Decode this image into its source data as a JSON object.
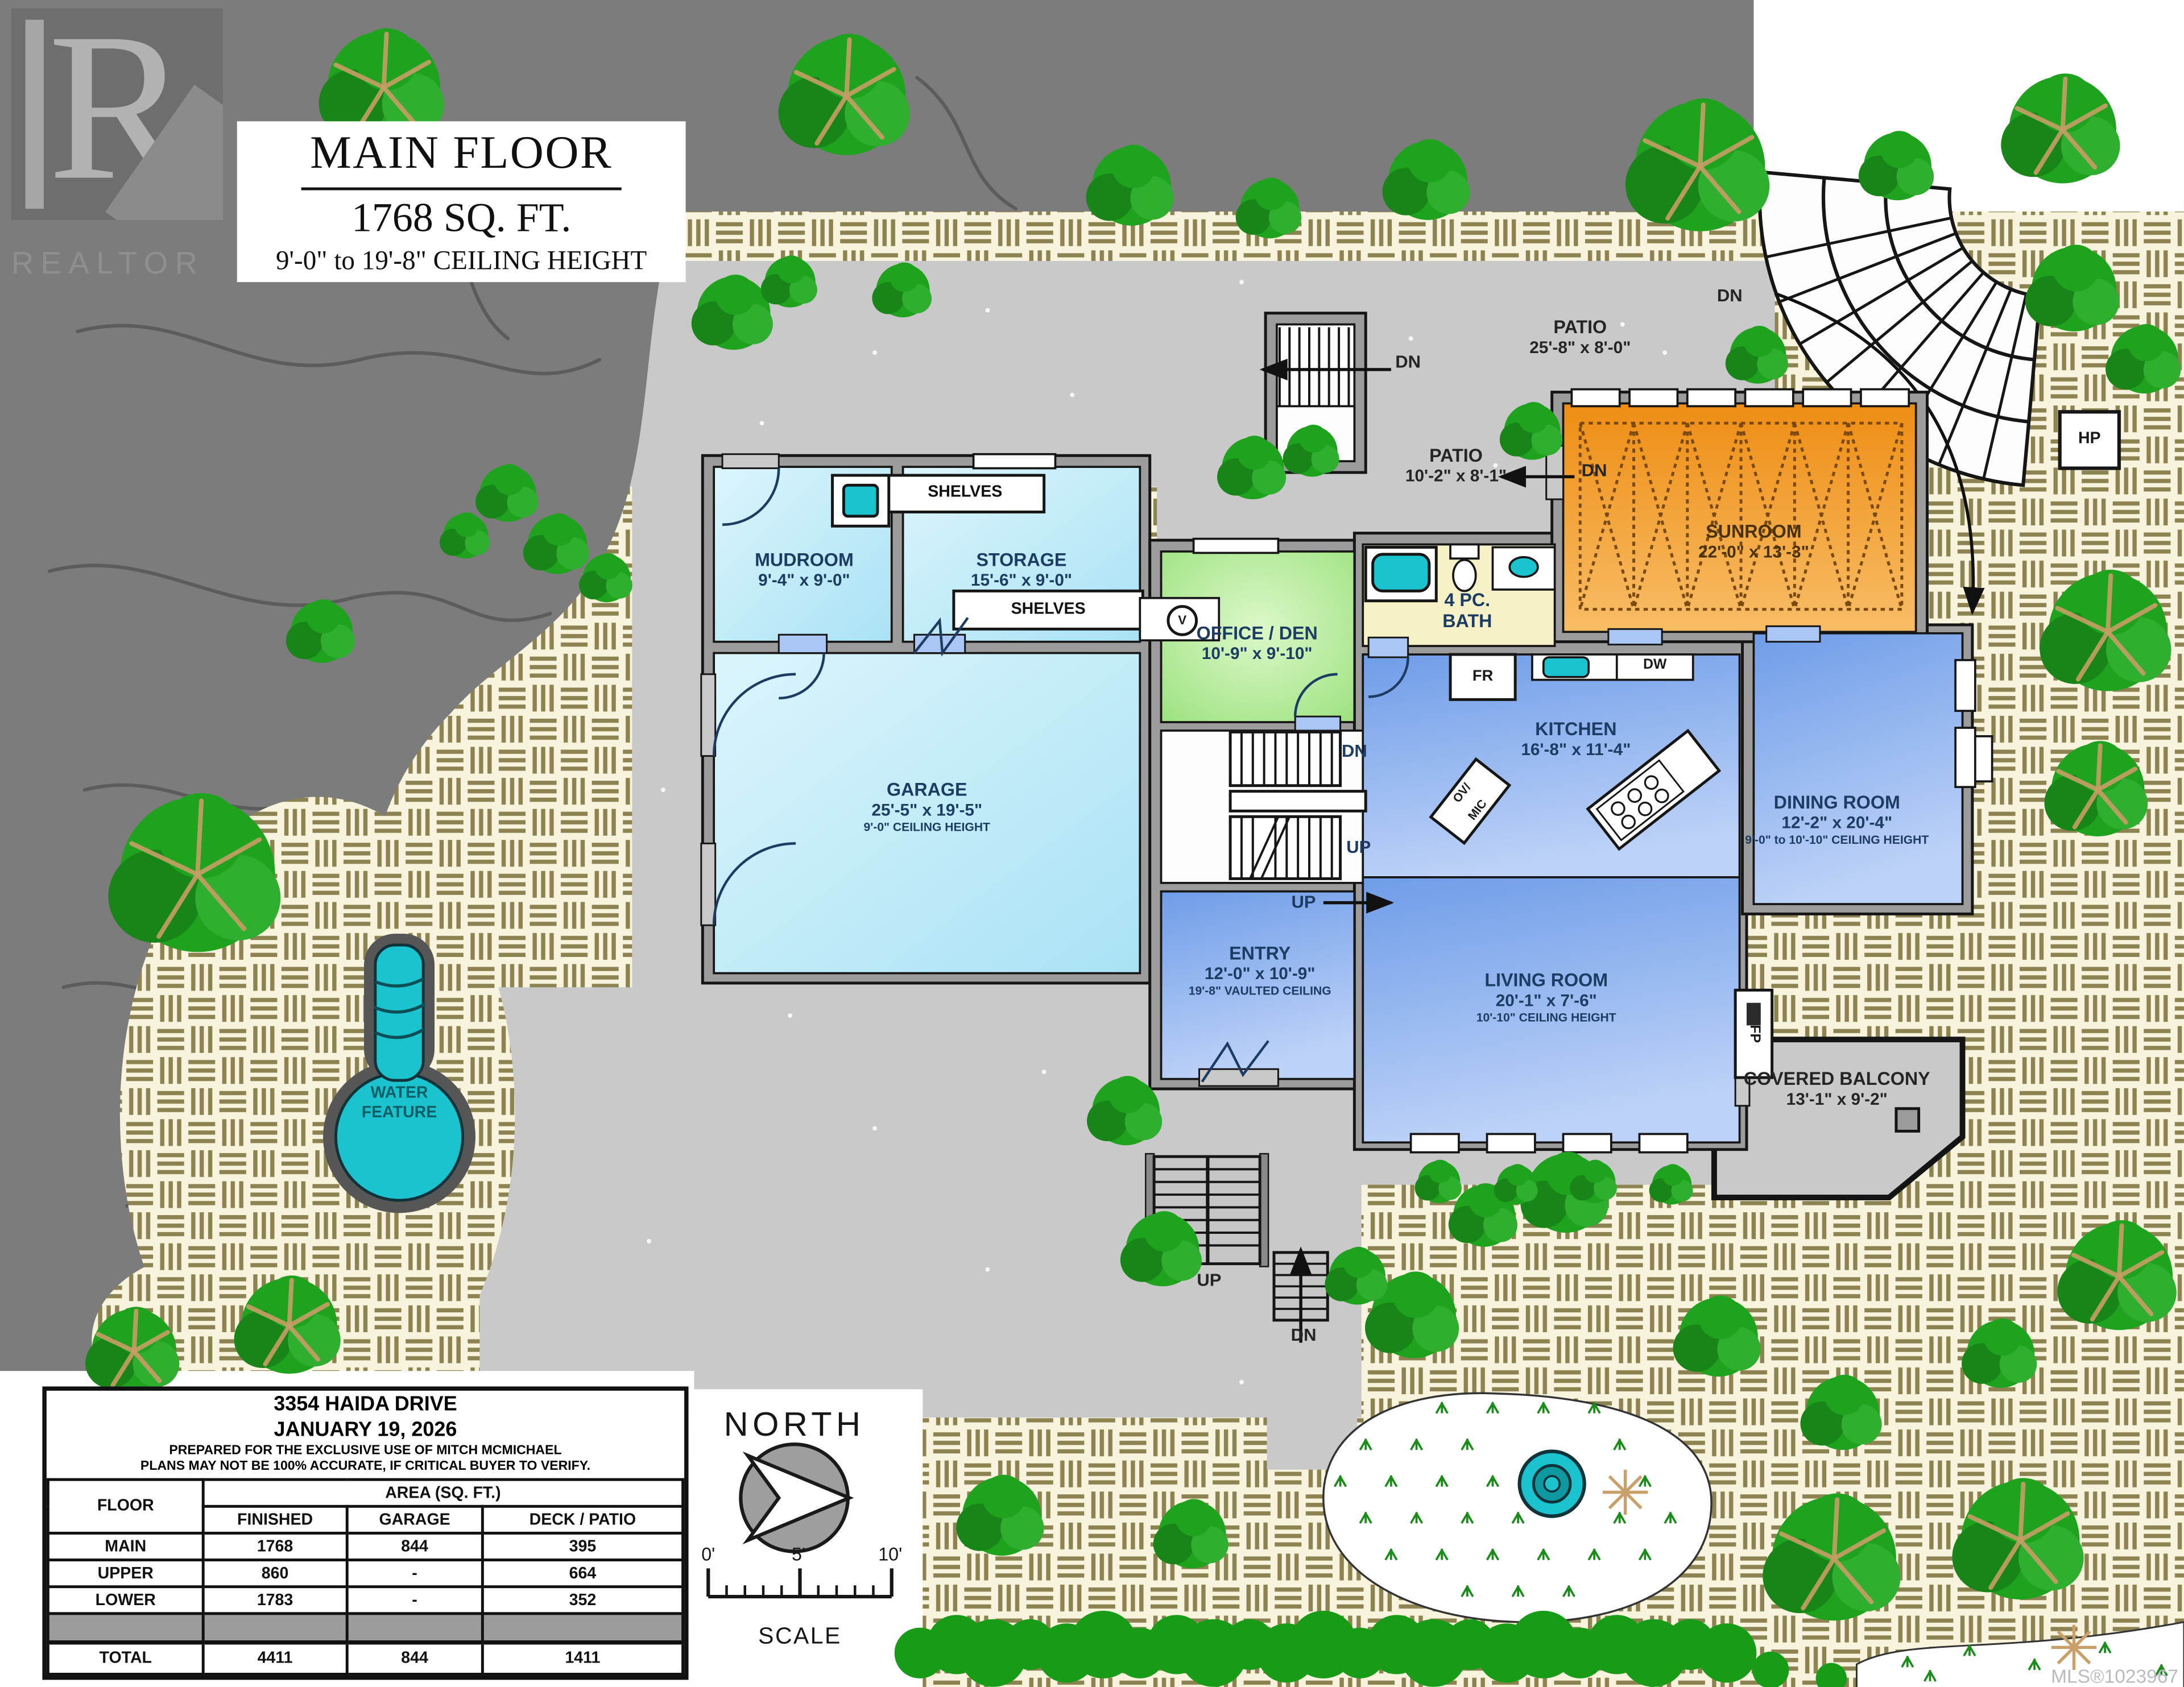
{
  "logo": {
    "r": "R",
    "text": "REALTOR"
  },
  "title": {
    "line1": "MAIN FLOOR",
    "line2": "1768 SQ. FT.",
    "line3": "9'-0\" to 19'-8\" CEILING HEIGHT"
  },
  "rooms": {
    "mudroom": {
      "name": "MUDROOM",
      "dims": "9'-4\" x 9'-0\""
    },
    "storage": {
      "name": "STORAGE",
      "dims": "15'-6\" x 9'-0\""
    },
    "shelves_top": "SHELVES",
    "shelves_bottom": "SHELVES",
    "office": {
      "name": "OFFICE / DEN",
      "dims": "10'-9\" x 9'-10\""
    },
    "bath": {
      "name": "4 PC.",
      "name2": "BATH"
    },
    "garage": {
      "name": "GARAGE",
      "dims": "25'-5\" x 19'-5\"",
      "note": "9'-0\" CEILING HEIGHT"
    },
    "kitchen": {
      "name": "KITCHEN",
      "dims": "16'-8\" x 11'-4\""
    },
    "dining": {
      "name": "DINING ROOM",
      "dims": "12'-2\" x 20'-4\"",
      "note": "9'-0\" to 10'-10\" CEILING HEIGHT"
    },
    "entry": {
      "name": "ENTRY",
      "dims": "12'-0\" x 10'-9\"",
      "note": "19'-8\" VAULTED CEILING"
    },
    "living": {
      "name": "LIVING ROOM",
      "dims": "20'-1\" x 7'-6\"",
      "note": "10'-10\" CEILING HEIGHT"
    },
    "sunroom": {
      "name": "SUNROOM",
      "dims": "22'-0\" x 13'-3\""
    },
    "balcony": {
      "name": "COVERED BALCONY",
      "dims": "13'-1\" x 9'-2\""
    },
    "patio_top": {
      "name": "PATIO",
      "dims": "25'-8\" x 8'-0\""
    },
    "patio_small": {
      "name": "PATIO",
      "dims": "10'-2\" x 8'-1\""
    },
    "water_feature": {
      "line1": "WATER",
      "line2": "FEATURE"
    }
  },
  "fixtures": {
    "fr": "FR",
    "dw": "DW",
    "ovmic1": "OV/",
    "ovmic2": "MIC",
    "fp": "FP",
    "v": "V",
    "hp": "HP"
  },
  "stairs": {
    "dn": "DN",
    "up": "UP"
  },
  "compass": {
    "label": "NORTH"
  },
  "scalebar": {
    "t0": "0'",
    "t5": "5'",
    "t10": "10'",
    "label": "SCALE"
  },
  "infobox": {
    "address": "3354 HAIDA DRIVE",
    "date": "JANUARY 19, 2026",
    "disclaimer1": "PREPARED FOR THE EXCLUSIVE USE OF MITCH MCMICHAEL",
    "disclaimer2": "PLANS MAY NOT BE 100% ACCURATE, IF CRITICAL BUYER TO VERIFY.",
    "table": {
      "col_floor": "FLOOR",
      "col_area": "AREA (SQ. FT.)",
      "col_finished": "FINISHED",
      "col_garage": "GARAGE",
      "col_deck": "DECK / PATIO",
      "rows": [
        {
          "floor": "MAIN",
          "finished": "1768",
          "garage": "844",
          "deck": "395"
        },
        {
          "floor": "UPPER",
          "finished": "860",
          "garage": "-",
          "deck": "664"
        },
        {
          "floor": "LOWER",
          "finished": "1783",
          "garage": "-",
          "deck": "352"
        }
      ],
      "total": {
        "floor": "TOTAL",
        "finished": "4411",
        "garage": "844",
        "deck": "1411"
      }
    }
  },
  "watermark": "MLS®1023967",
  "colors": {
    "teal": "#1ac3cd",
    "sunroom_orange": "#f09a2e",
    "room_blue": "#8fb2ee",
    "room_light_blue": "#bfe8f7",
    "office_green": "#b8ec9c",
    "bath_yellow": "#f6f1c6",
    "paver_cream": "#f8f3dc",
    "terrain_gray": "#7c7c7c",
    "driveway_gray": "#c9c9c9",
    "tree_green": "#1fa31f",
    "label_navy": "#1d3c63"
  }
}
